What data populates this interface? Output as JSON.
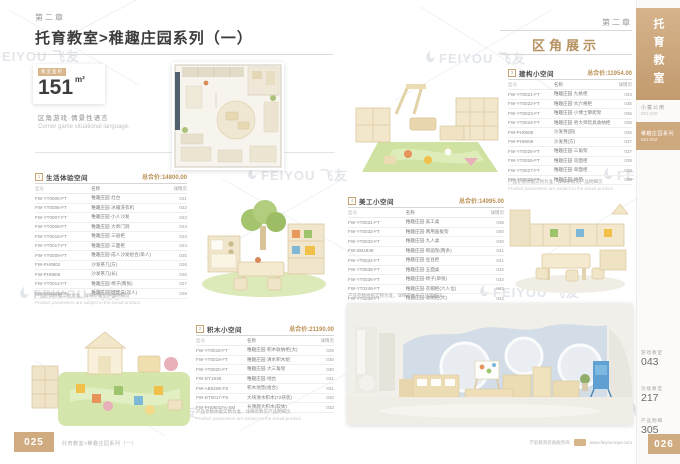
{
  "page": {
    "watermark": "FEIYOU 飞友",
    "left_chapter": "第二章",
    "title": "托育教室>稚趣庄园系列（一）",
    "right_chapter": "第二章",
    "right_section": "区角展示"
  },
  "icons": {
    "watermark_logo": "feiyou-drop-logo"
  },
  "sidebar": {
    "tab": "托育教室",
    "group_label": "小童公用",
    "group_range": "001-020",
    "active_label": "稚趣庄园系列",
    "active_range": "021-042",
    "links": [
      {
        "label": "游戏教室",
        "page": "043"
      },
      {
        "label": "功能教室",
        "page": "217"
      },
      {
        "label": "产品明细",
        "page": "305"
      }
    ],
    "page_number": "026"
  },
  "footer": {
    "page_number": "025",
    "series_text": "托育教室>稚趣庄园系列（一）",
    "company_text": "学前教育装备服务商",
    "website": "www.feiyou-toys.com"
  },
  "area_card": {
    "label": "教室面积",
    "value": "151",
    "unit": "m²"
  },
  "intro": {
    "cn": "区角游戏·情景性语言",
    "en": "Corner game situational language."
  },
  "tables": [
    {
      "num": "1",
      "title": "生活体验空间",
      "total_label": "总合价:",
      "total": "14800.00",
      "columns": [
        "型号",
        "名称",
        "详情页"
      ],
      "rows": [
        [
          "FW-YT0005-FT",
          "稚趣庄园·灶台",
          "021"
        ],
        [
          "FW-YT0006-FT",
          "稚趣庄园·冰箱洗衣机",
          "022"
        ],
        [
          "FW-YT0007-FT",
          "稚趣庄园·小人沙发",
          "023"
        ],
        [
          "FW-YT0008-FT",
          "稚趣庄园·大师门洞",
          "023"
        ],
        [
          "FW-YT0016-FT",
          "稚趣庄园·三层柜",
          "024"
        ],
        [
          "FW-YT0017-FT",
          "稚趣庄园·三面柜",
          "024"
        ],
        [
          "FW-YT0009-FT",
          "稚趣庄园·成人沙发组合(单人)",
          "025"
        ],
        [
          "FW-PH0802",
          "沙发茶几(方)",
          "026"
        ],
        [
          "FW-PH0808",
          "沙发茶几(长)",
          "026"
        ],
        [
          "FW-YT0012-FT",
          "稚趣庄园·椅子(两张)",
          "027"
        ],
        [
          "FW-YT0248-FT",
          "稚趣庄园·娃娃床(双人)",
          "028"
        ]
      ],
      "note_cn": "产品参数依据实物为准，详细参数见产品明细页",
      "note_en": "Product parameters are subject to the actual product."
    },
    {
      "num": "2",
      "title": "积木小空间",
      "total_label": "总合价:",
      "total": "21190.00",
      "columns": [
        "型号",
        "名称",
        "详情页"
      ],
      "rows": [
        [
          "FW-YT0018-FT",
          "稚趣庄园·积木收纳柜(大)",
          "029"
        ],
        [
          "FW-YT0019-FT",
          "稚趣庄园·清水积木组",
          "030"
        ],
        [
          "FW-YT0020-FT",
          "稚趣庄园·大三角架",
          "030"
        ],
        [
          "FW-DY1838",
          "稚趣庄园·地台",
          "031"
        ],
        [
          "FW-AB0205-FS",
          "积木地垫(组合)",
          "031"
        ],
        [
          "FW-DT0017-FS",
          "大块清水积木(72块装)",
          "032"
        ],
        [
          "FW-PH0801FA-SM",
          "长颈鹿大积木(软体)",
          "033"
        ]
      ],
      "note_cn": "产品参数依据实物为准，详细参数见产品明细页",
      "note_en": "Product parameters are subject to the actual product."
    },
    {
      "num": "3",
      "title": "建构小空间",
      "total_label": "总合价:",
      "total": "11954.00",
      "columns": [
        "型号",
        "名称",
        "详情页"
      ],
      "rows": [
        [
          "FW-YT0021-FT",
          "稚趣庄园·九格柜",
          "034"
        ],
        [
          "FW-YT0022-FT",
          "稚趣庄园·大六格柜",
          "035"
        ],
        [
          "FW-YT0023-FT",
          "稚趣庄园·小博士攀爬架",
          "035"
        ],
        [
          "FW-YT0024-FT",
          "稚趣庄园·男大师玩具收纳柜",
          "036"
        ],
        [
          "FW-PH0508",
          "沙发凳(圆)",
          "036"
        ],
        [
          "FW-PH0608",
          "沙发凳(方)",
          "037"
        ],
        [
          "FW-YT0025-FT",
          "稚趣庄园·三角架",
          "037"
        ],
        [
          "FW-YT0026-FT",
          "稚趣庄园·双面柜",
          "038"
        ],
        [
          "FW-YT0027-FT",
          "稚趣庄园·单面柜",
          "038"
        ],
        [
          "FW-YT0028-FT",
          "稚趣庄园·地垫",
          "039"
        ]
      ],
      "note_cn": "产品参数依据实物为准，详细参数见产品明细页",
      "note_en": "Product parameters are subject to the actual product."
    },
    {
      "num": "4",
      "title": "美工小空间",
      "total_label": "总合价:",
      "total": "14995.00",
      "columns": [
        "型号",
        "名称",
        "详情页"
      ],
      "rows": [
        [
          "FW-YT0031-FT",
          "稚趣庄园·美工桌",
          "039"
        ],
        [
          "FW-YT0032-FT",
          "稚趣庄园·两用画板架",
          "040"
        ],
        [
          "FW-YT0033-FT",
          "稚趣庄园·九人桌",
          "040"
        ],
        [
          "FW-ZM1838",
          "稚趣庄园·晾画架(两条)",
          "041"
        ],
        [
          "FW-YT0034-FT",
          "稚趣庄园·豆豆柜",
          "041"
        ],
        [
          "FW-YT0035-FT",
          "稚趣庄园·五面桌",
          "042"
        ],
        [
          "FW-YT0036-FT",
          "稚趣庄园·椅子(单张)",
          "042"
        ],
        [
          "FW-YT0248-FT",
          "稚趣庄园·衣帽柜(六人位)",
          "042"
        ],
        [
          "FW-YT0208-FT",
          "稚趣庄园·收纳柜(大)",
          "042"
        ]
      ],
      "note_cn": "产品参数依据实物为准，详细参数见产品明细页",
      "note_en": "Product parameters are subject to the actual product."
    }
  ],
  "colors": {
    "accent_tan": "#cfab7f",
    "title_dark": "#3c3c3c",
    "price_gold": "#ba9156",
    "watermark_gray": "#e2e6ea"
  }
}
